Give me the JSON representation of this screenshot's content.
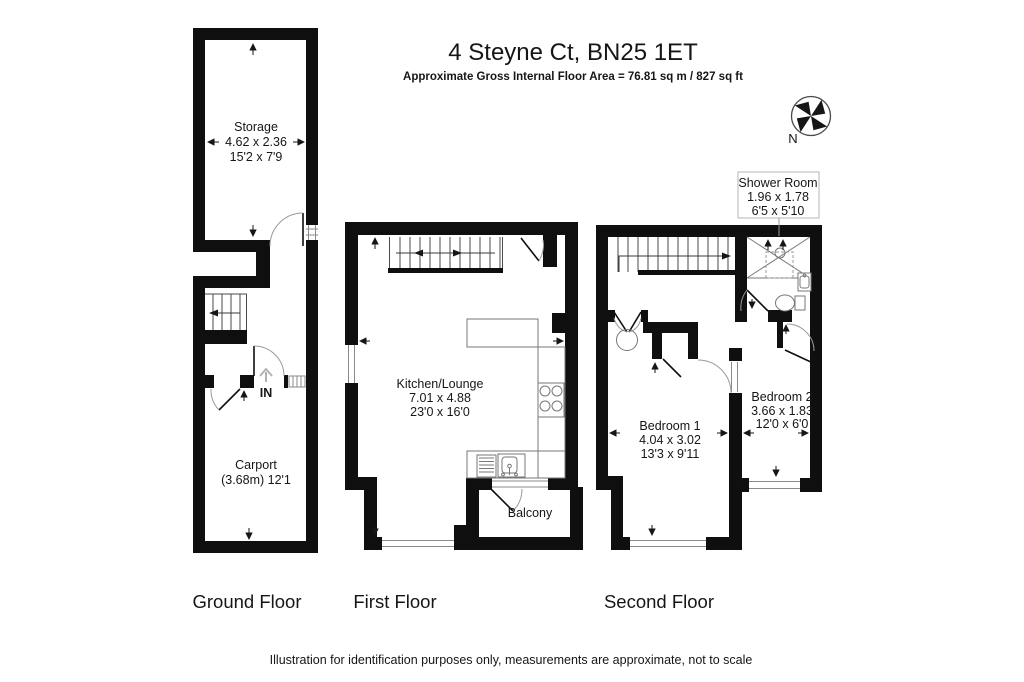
{
  "header": {
    "title": "4 Steyne Ct, BN25 1ET",
    "subtitle": "Approximate Gross Internal Floor Area = 76.81 sq m / 827 sq ft"
  },
  "compass": {
    "north": "N"
  },
  "floors": {
    "ground": {
      "label": "Ground Floor",
      "rooms": {
        "storage": {
          "name": "Storage",
          "metric": "4.62 x 2.36",
          "imperial": "15'2 x 7'9"
        },
        "carport": {
          "name": "Carport",
          "dims": "(3.68m) 12'1"
        },
        "entrance": {
          "label": "IN"
        }
      }
    },
    "first": {
      "label": "First Floor",
      "rooms": {
        "kitchen_lounge": {
          "name": "Kitchen/Lounge",
          "metric": "7.01 x 4.88",
          "imperial": "23'0 x 16'0"
        },
        "balcony": {
          "name": "Balcony"
        }
      }
    },
    "second": {
      "label": "Second Floor",
      "rooms": {
        "shower_room": {
          "name": "Shower Room",
          "metric": "1.96 x 1.78",
          "imperial": "6'5 x 5'10"
        },
        "bedroom1": {
          "name": "Bedroom 1",
          "metric": "4.04 x 3.02",
          "imperial": "13'3 x 9'11"
        },
        "bedroom2": {
          "name": "Bedroom 2",
          "metric": "3.66 x 1.83",
          "imperial": "12'0 x 6'0"
        }
      }
    }
  },
  "footer": {
    "disclaimer": "Illustration for identification purposes only, measurements are approximate, not to scale"
  },
  "colors": {
    "wall": "#0f0f0f",
    "text": "#161616",
    "background": "#ffffff",
    "door_arc": "#9a9a9a",
    "window_line": "#8a8a8a",
    "label_box_border": "#b5b5b5",
    "in_arrow": "#b3b3b3"
  }
}
